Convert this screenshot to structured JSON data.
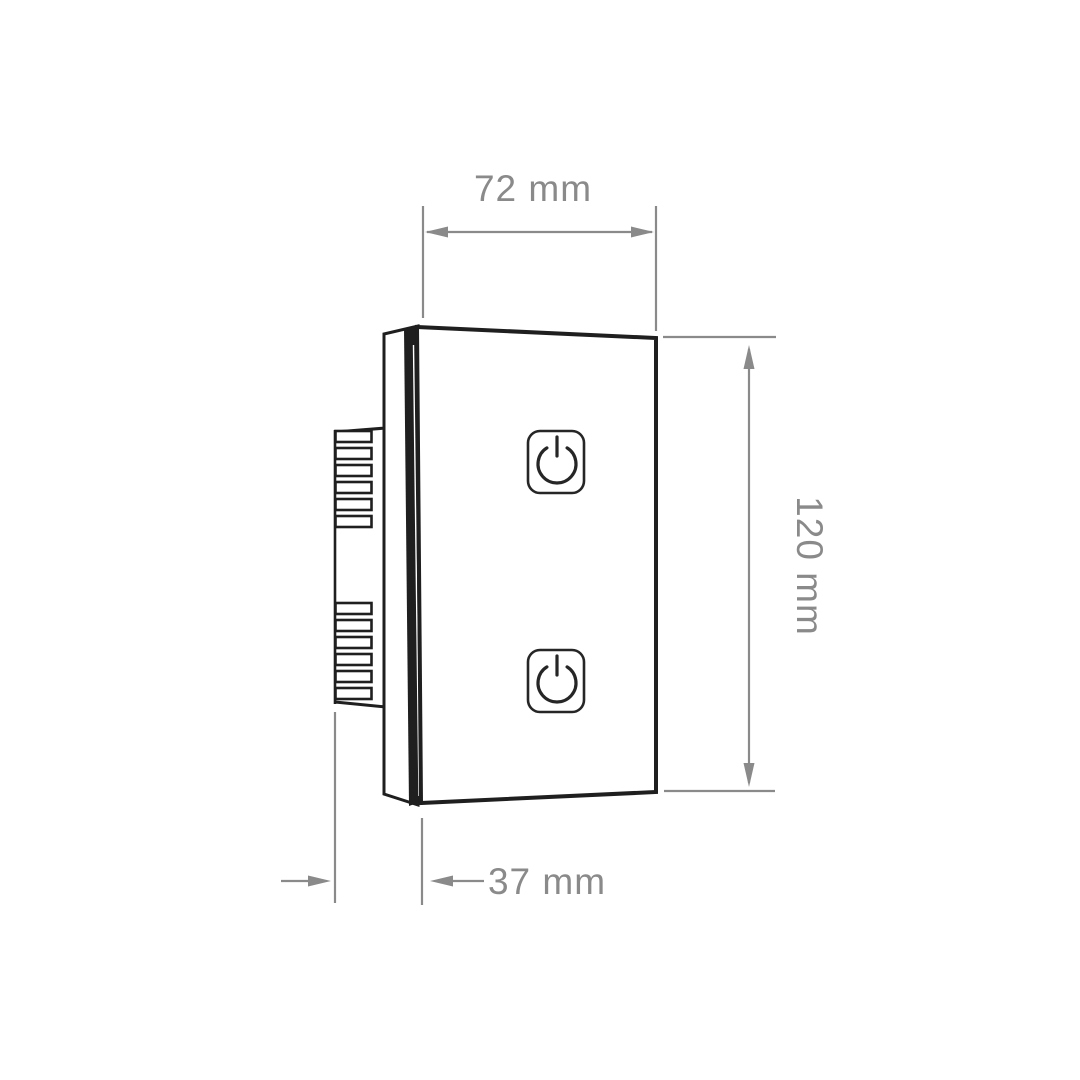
{
  "figure": {
    "drawing": {
      "subject": "two-gang-touch-wall-switch-side-perspective-view",
      "colors": {
        "background": "#ffffff",
        "outline": "#1f1f1f",
        "dimension": "#8a8a8a"
      },
      "buttons": [
        {
          "id": "touch-button-top",
          "icon": "power-icon"
        },
        {
          "id": "touch-button-bottom",
          "icon": "power-icon"
        }
      ],
      "dimensions": {
        "width": {
          "label": "72 mm",
          "value": 72,
          "unit": "mm",
          "position": "top"
        },
        "height": {
          "label": "120 mm",
          "value": 120,
          "unit": "mm",
          "position": "right"
        },
        "depth": {
          "label": "37 mm",
          "value": 37,
          "unit": "mm",
          "position": "bottom"
        }
      }
    }
  }
}
